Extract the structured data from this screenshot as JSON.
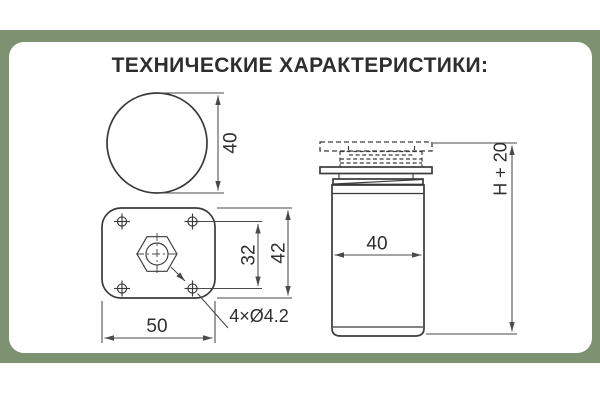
{
  "title": "ТЕХНИЧЕСКИЕ ХАРАКТЕРИСТИКИ:",
  "colors": {
    "band": "#7c9270",
    "card": "#ffffff",
    "line": "#3a3a3a",
    "line2": "#4a4a4a",
    "text": "#2e2e2e"
  },
  "drawing": {
    "top_view": {
      "diameter": "40"
    },
    "plate_view": {
      "hole_spacing": "32",
      "height": "42",
      "width": "50",
      "holes": "4×Ø4.2"
    },
    "side_view": {
      "diameter": "40",
      "height": "H + 20"
    }
  }
}
